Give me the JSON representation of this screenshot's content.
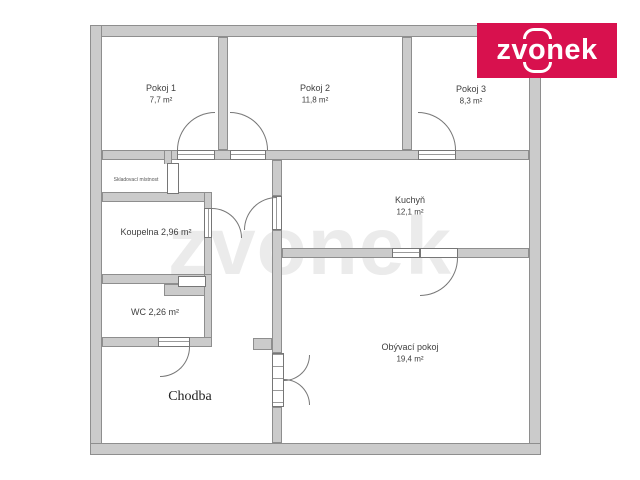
{
  "logo": {
    "background": "#d8114e",
    "brand": "zvonek",
    "part1": "zv",
    "part_o": "o",
    "part2": "nek"
  },
  "watermark": {
    "text": "zvonek"
  },
  "floorplan": {
    "wall_color": "#cbcbcb",
    "rooms": {
      "pokoj1": {
        "name": "Pokoj 1",
        "area": "7,7 m²"
      },
      "pokoj2": {
        "name": "Pokoj 2",
        "area": "11,8 m²"
      },
      "pokoj3": {
        "name": "Pokoj 3",
        "area": "8,3 m²"
      },
      "kuchyn": {
        "name": "Kuchyň",
        "area": "12,1 m²"
      },
      "obyvaci": {
        "name": "Obývací pokoj",
        "area": "19,4 m²"
      },
      "koupelna": {
        "label": "Koupelna 2,96 m²"
      },
      "wc": {
        "label": "WC 2,26 m²"
      },
      "sklad": {
        "label": "Skladovací místnost"
      },
      "chodba": {
        "label": "Chodba"
      }
    }
  }
}
